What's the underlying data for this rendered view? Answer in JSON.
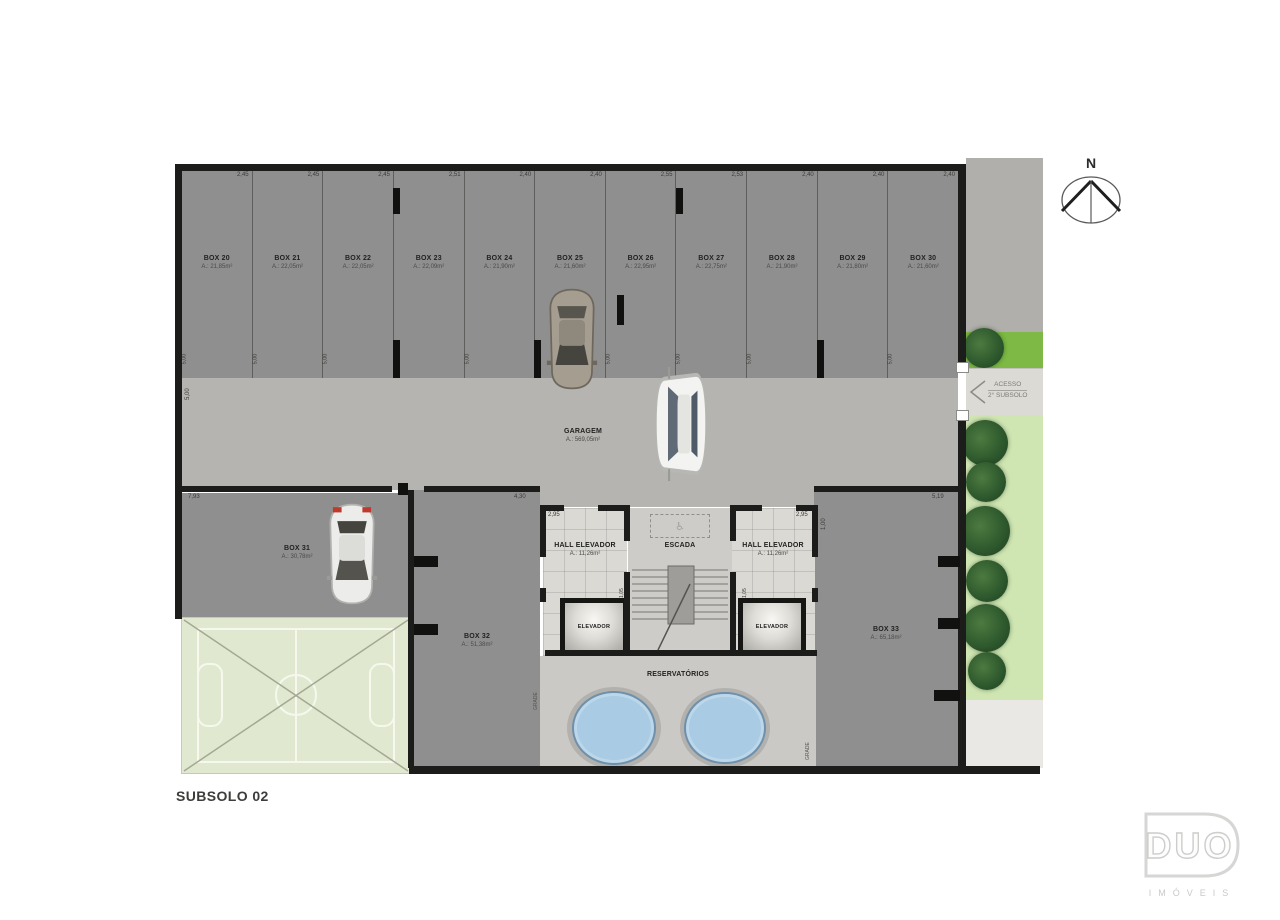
{
  "page": {
    "title": "SUBSOLO 02"
  },
  "plan": {
    "boxes_top": [
      {
        "name": "BOX 20",
        "area": "A.: 21,85m²",
        "dim": "2,45"
      },
      {
        "name": "BOX 21",
        "area": "A.: 22,05m²",
        "dim": "2,45"
      },
      {
        "name": "BOX 22",
        "area": "A.: 22,05m²",
        "dim": "2,45"
      },
      {
        "name": "BOX 23",
        "area": "A.: 22,09m²",
        "dim": "2,51"
      },
      {
        "name": "BOX 24",
        "area": "A.: 21,90m²",
        "dim": "2,40"
      },
      {
        "name": "BOX 25",
        "area": "A.: 21,60m²",
        "dim": "2,40"
      },
      {
        "name": "BOX 26",
        "area": "A.: 22,95m²",
        "dim": "2,55"
      },
      {
        "name": "BOX 27",
        "area": "A.: 22,75m²",
        "dim": "2,53"
      },
      {
        "name": "BOX 28",
        "area": "A.: 21,90m²",
        "dim": "2,40"
      },
      {
        "name": "BOX 29",
        "area": "A.: 21,80m²",
        "dim": "2,40"
      },
      {
        "name": "BOX 30",
        "area": "A.: 21,60m²",
        "dim": "2,40"
      }
    ],
    "box_depth_dim": "5,00",
    "garagem": {
      "name": "GARAGEM",
      "area": "A.: 569,05m²"
    },
    "box31": {
      "name": "BOX 31",
      "area": "A.: 30,78m²",
      "dim": "7,93"
    },
    "box32": {
      "name": "BOX 32",
      "area": "A.: 51,38m²",
      "dim": "4,30"
    },
    "box33": {
      "name": "BOX 33",
      "area": "A.: 65,18m²",
      "dim": "5,19"
    },
    "hall_left": {
      "name": "HALL ELEVADOR",
      "area": "A.: 11,26m²",
      "dim": "2,95"
    },
    "hall_right": {
      "name": "HALL ELEVADOR",
      "area": "A.: 11,26m²",
      "dim": "2,95"
    },
    "escada": {
      "name": "ESCADA"
    },
    "elevador_left": {
      "name": "ELEVADOR"
    },
    "elevador_right": {
      "name": "ELEVADOR"
    },
    "reservatorios": {
      "name": "RESERVATÓRIOS"
    },
    "dims": {
      "lane_left": "5,00",
      "hall_side_right": "1,00",
      "stair_left": "1,05",
      "stair_right": "1,05",
      "grade_left": "GRADE",
      "grade_right": "GRADE"
    }
  },
  "access": {
    "line1": "ACESSO",
    "line2": "2° SUBSOLO"
  },
  "north": {
    "label": "N"
  },
  "logo": {
    "name": "DUO",
    "subtitle": "IMÓVEIS"
  },
  "colors": {
    "box_fill": "#8f8f8f",
    "lane_fill": "#b5b4b1",
    "hall_tile": "#dbd9d4",
    "reservatorio_fill": "#cac9c5",
    "tank_blue": "#a9cbe3",
    "court_green": "#e0e9d0",
    "grass_bright": "#7db944",
    "grass_light": "#cfe5b2",
    "sidewalk_gray": "#b1afac",
    "sidewalk_light": "#e9e8e4",
    "wall_black": "#1c1c1a"
  }
}
